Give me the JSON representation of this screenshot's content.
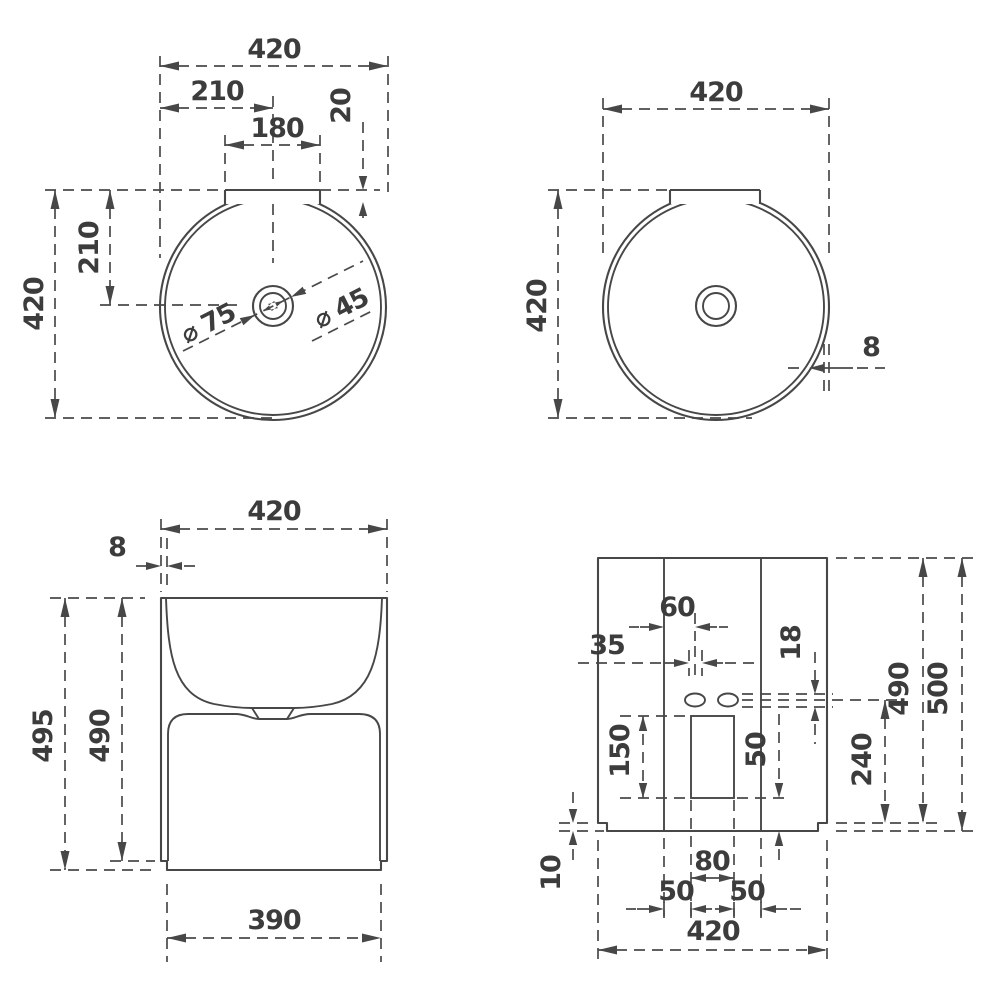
{
  "drawing": {
    "type": "technical-dimension-drawing",
    "subject": "round freestanding washbasin - four orthographic views",
    "colors": {
      "background": "#ffffff",
      "line": "#474747",
      "text": "#3c3c3c"
    },
    "views": {
      "plan_dimensioned": {
        "label": "top view with tap-ledge and drain dimensions",
        "dims": {
          "width": "420",
          "half_width": "210",
          "ledge_width": "180",
          "ledge_depth": "20",
          "half_depth": "210",
          "depth": "420",
          "drain_outer": "⌀ 75",
          "drain_inner": "⌀ 45"
        }
      },
      "plan_plain": {
        "label": "top view with wall thickness",
        "dims": {
          "width": "420",
          "depth": "420",
          "wall": "8"
        }
      },
      "front": {
        "label": "front elevation",
        "dims": {
          "width": "420",
          "wall": "8",
          "height": "495",
          "inner_height": "490",
          "base_width": "390"
        }
      },
      "back": {
        "label": "rear elevation with service cutout",
        "dims": {
          "hole_offset": "60",
          "hole_gap": "35",
          "slot_height": "18",
          "cutout_height": "150",
          "cutout_to_bottom": "50",
          "drop": "240",
          "slot_floor_height": "490",
          "total_height": "500",
          "plinth": "10",
          "cutout_width": "80",
          "left_gap": "50",
          "right_gap": "50",
          "width": "420"
        }
      }
    }
  }
}
